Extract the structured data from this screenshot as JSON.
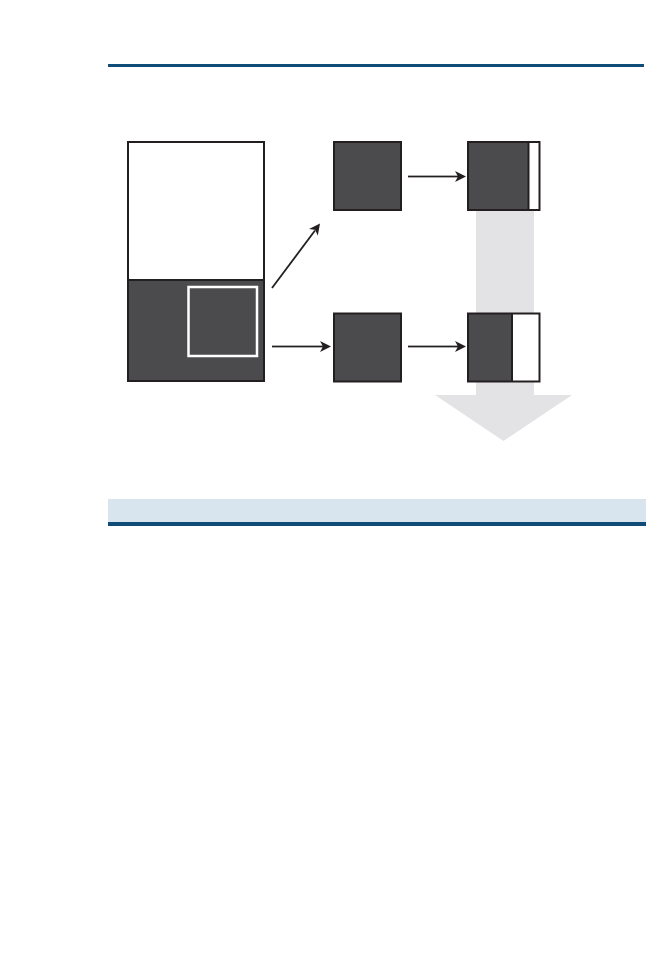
{
  "page": {
    "background": "#ffffff"
  },
  "colors": {
    "rule_blue": "#0f4d78",
    "band_light_blue": "#d9e5ee",
    "box_dark_gray": "#4b4b4d",
    "outline_black": "#231f20",
    "selection_white": "#ffffff",
    "box_white": "#ffffff",
    "flow_arrow_gray": "#e3e3e6",
    "arrow_black": "#231f20",
    "no_fill": "none"
  }
}
